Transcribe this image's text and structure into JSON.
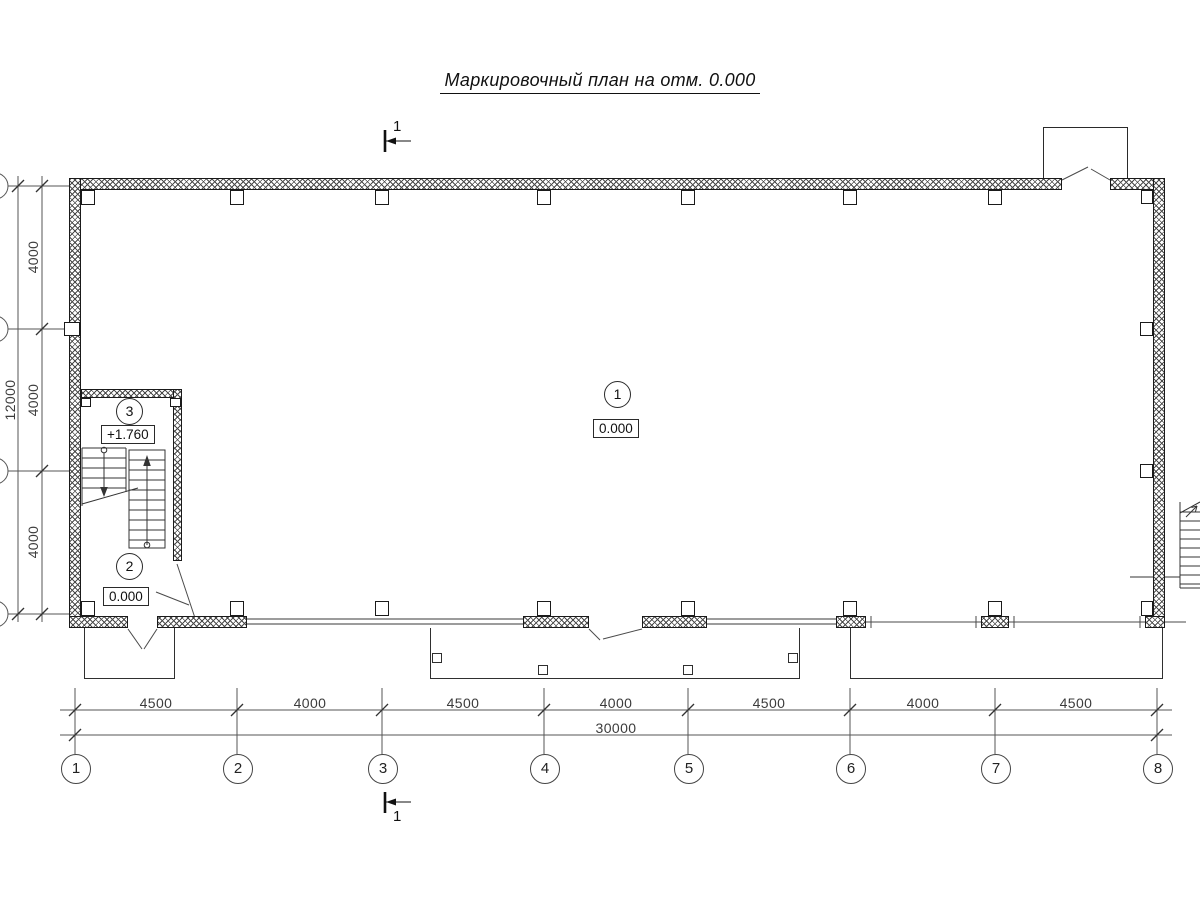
{
  "title": "Маркировочный план на отм. 0.000",
  "section_mark": {
    "top_label": "1",
    "bottom_label": "1"
  },
  "axes": {
    "column_labels": [
      "1",
      "2",
      "3",
      "4",
      "5",
      "6",
      "7",
      "8"
    ],
    "column_spacings": [
      "4500",
      "4000",
      "4500",
      "4000",
      "4500",
      "4000",
      "4500"
    ],
    "total_width": "30000",
    "row_spacings": [
      "4000",
      "4000",
      "4000"
    ],
    "total_height": "12000"
  },
  "rooms": [
    {
      "number": "1",
      "elevation": "0.000"
    },
    {
      "number": "2",
      "elevation": "0.000"
    },
    {
      "number": "3",
      "elevation": "+1.760"
    }
  ],
  "colors": {
    "ink": "#1a1a1a",
    "background": "#ffffff"
  }
}
